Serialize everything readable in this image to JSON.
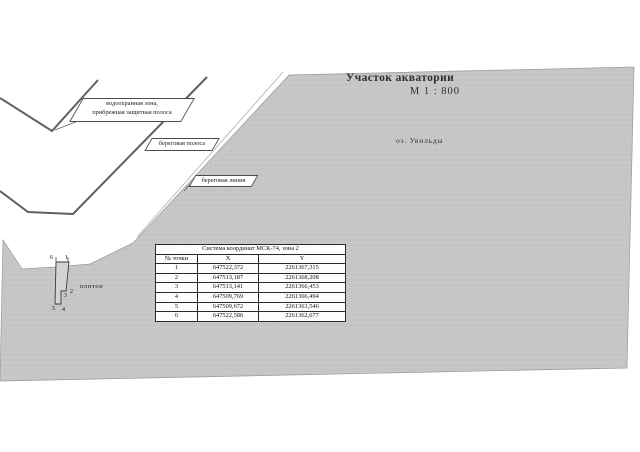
{
  "map": {
    "title": "Участок акватории",
    "scale": "М 1 : 800",
    "lake_label": "оз. Увильды",
    "zone_label_line1": "водоохранная зона,",
    "zone_label_line2": "прибрежная защитная полоса",
    "shore_strip_label": "береговая полоса",
    "shoreline_label": "береговая линия",
    "pontoon_label": "понтон",
    "pontoon_point_labels": {
      "p1": "1",
      "p2": "2",
      "p3": "3",
      "p4": "4",
      "p5": "5",
      "p6": "6"
    }
  },
  "coords_table": {
    "title": "Система координат МСК-74, зона 2",
    "columns": [
      "№ точки",
      "X",
      "Y"
    ],
    "rows": [
      [
        "1",
        "647522,372",
        "2261367,315"
      ],
      [
        "2",
        "647513,187",
        "2261368,208"
      ],
      [
        "3",
        "647513,141",
        "2261366,453"
      ],
      [
        "4",
        "647509,769",
        "2261366,494"
      ],
      [
        "5",
        "647509,672",
        "2261363,546"
      ],
      [
        "6",
        "647522,586",
        "2261362,677"
      ]
    ]
  },
  "colors": {
    "water_fill": "#c6c6c6",
    "pontoon_fill": "#d3d3d3",
    "boundary_line": "#5f5f5f",
    "text": "#1d1d1d"
  }
}
